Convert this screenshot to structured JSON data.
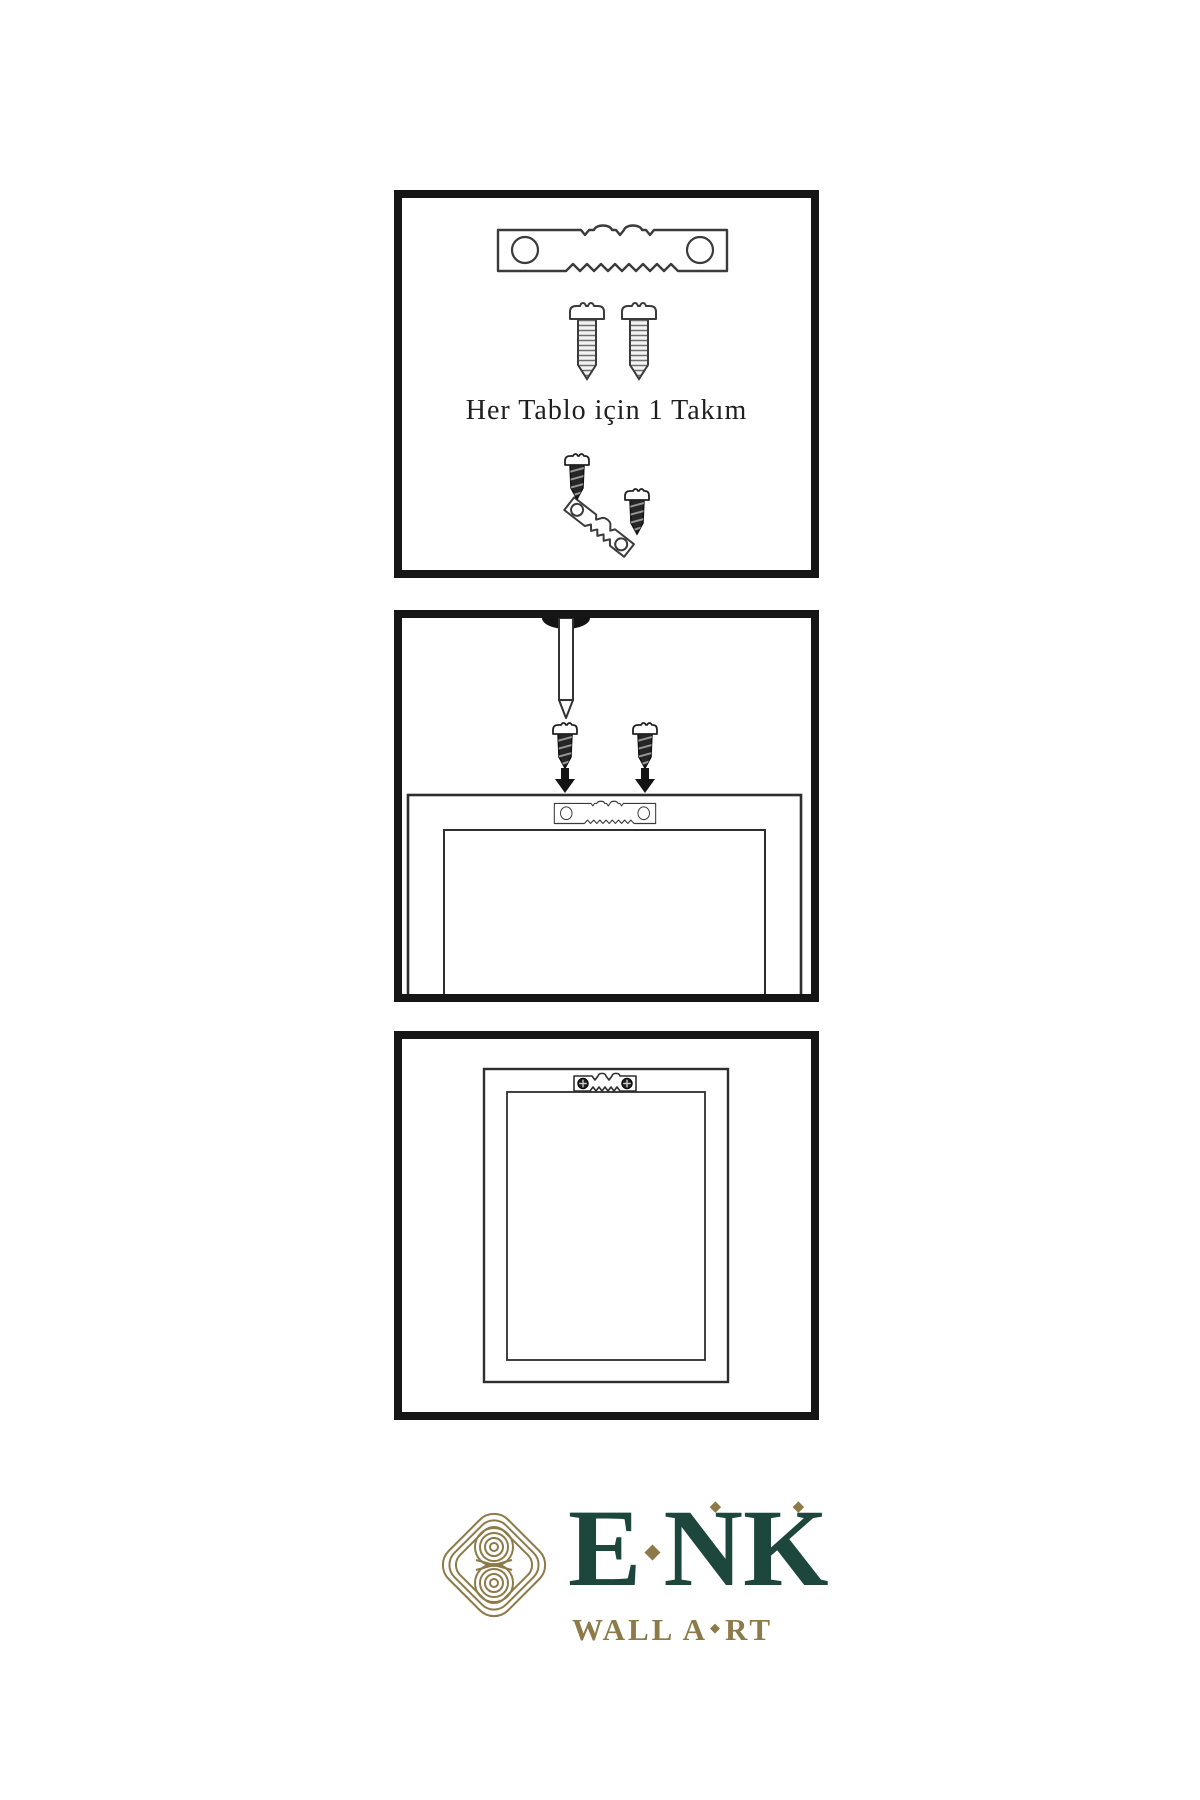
{
  "page": {
    "background": "#ffffff",
    "ink": "#3b3b3b"
  },
  "steps": {
    "step1": {
      "caption": "Her Tablo için 1 Takım"
    },
    "step2": {
      "description_icons": [
        "nail-icon",
        "screw-icon",
        "arrow-down-icon",
        "sawtooth-hanger-icon",
        "frame-back-icon"
      ]
    },
    "step3": {
      "description_icons": [
        "framed-picture-icon",
        "installed-hanger-icon"
      ]
    }
  },
  "logo": {
    "brand": {
      "letters": [
        "E",
        "N",
        "K"
      ]
    },
    "subtitle": {
      "left": "WALL A",
      "right": "RT"
    },
    "glyphs": {
      "diamond": "◆"
    },
    "colors": {
      "green": "#1d473c",
      "gold": "#8d7a49"
    }
  }
}
